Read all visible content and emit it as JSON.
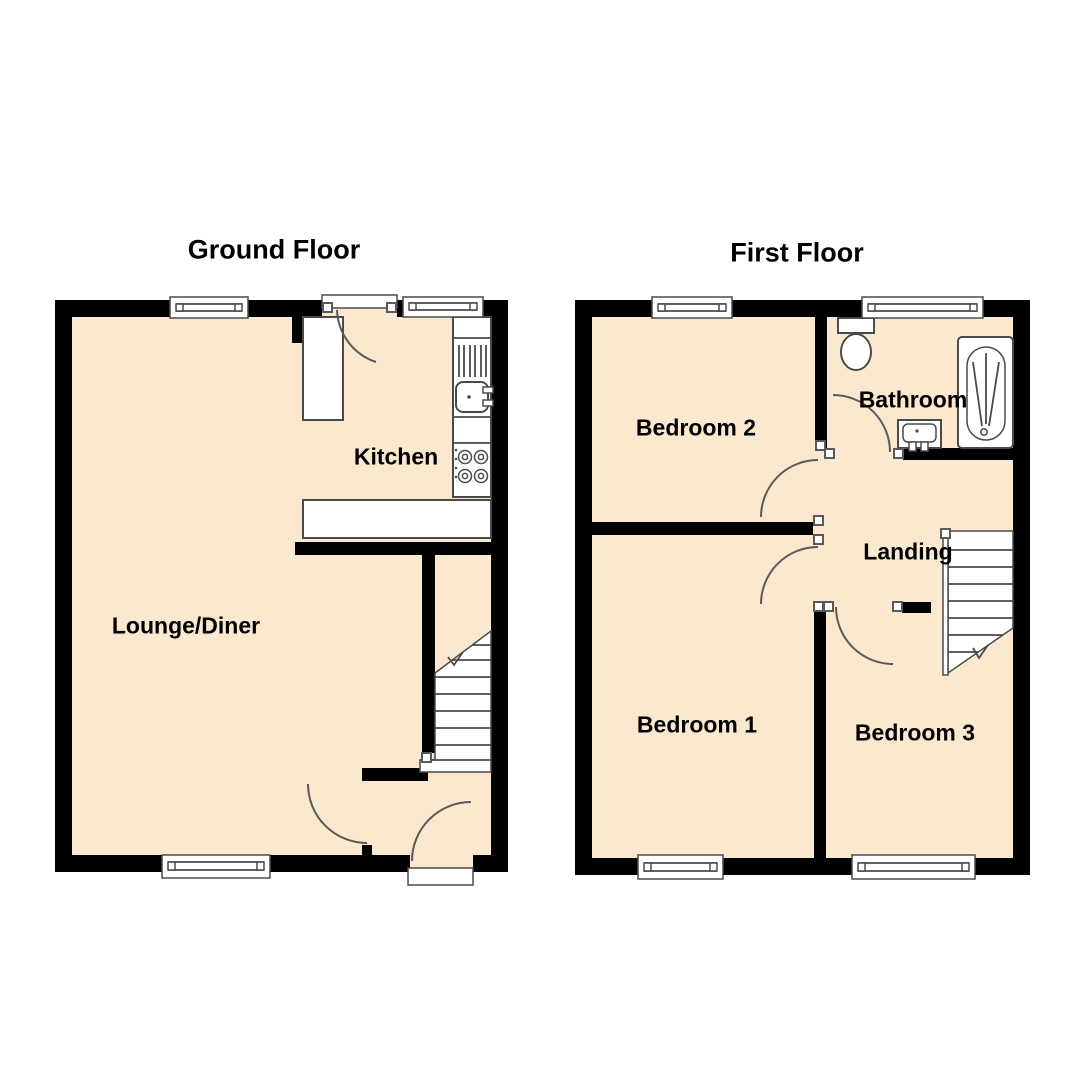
{
  "document": {
    "type": "floorplan"
  },
  "floors": [
    {
      "id": "ground",
      "title": "Ground Floor",
      "rooms": [
        {
          "label": "Kitchen"
        },
        {
          "label": "Lounge/Diner"
        }
      ]
    },
    {
      "id": "first",
      "title": "First Floor",
      "rooms": [
        {
          "label": "Bedroom 2"
        },
        {
          "label": "Bathroom"
        },
        {
          "label": "Landing"
        },
        {
          "label": "Bedroom 1"
        },
        {
          "label": "Bedroom 3"
        }
      ]
    }
  ],
  "colors": {
    "floor_fill": "#FAE9CE",
    "wall": "#000000",
    "line": "#4a4a4a",
    "text": "#000000",
    "bg": "#ffffff"
  }
}
